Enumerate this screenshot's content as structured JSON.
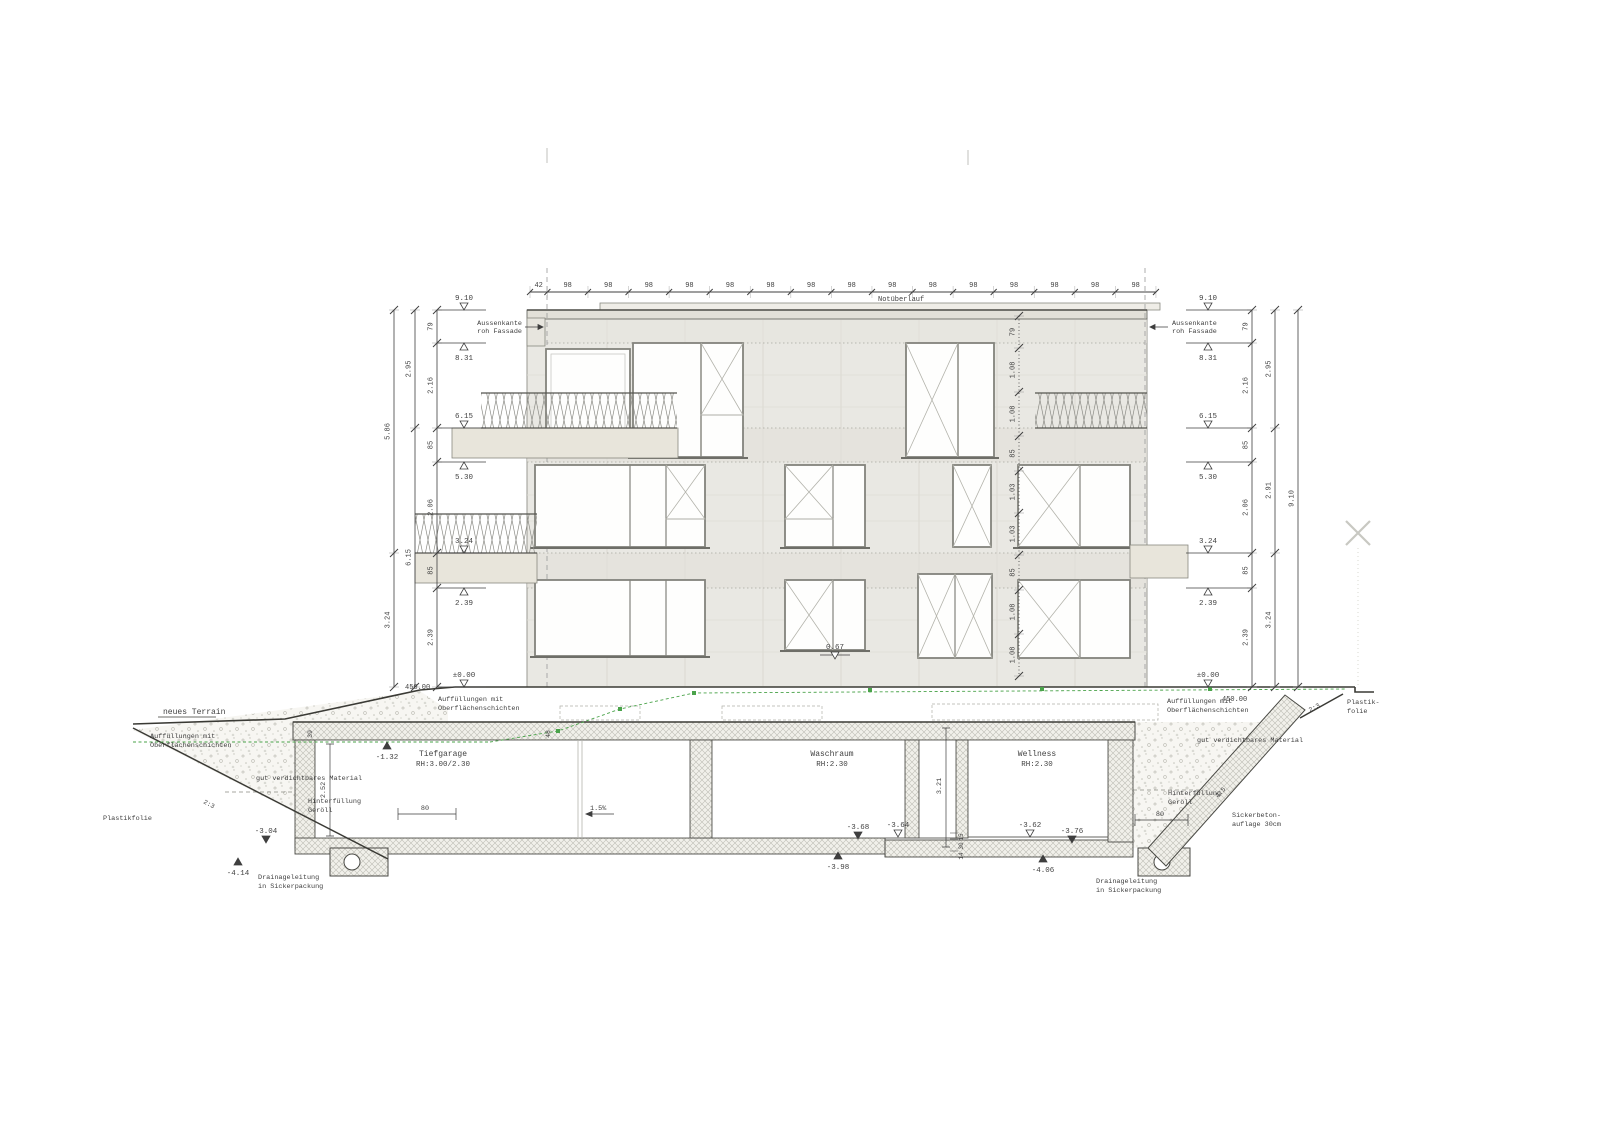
{
  "title": "Gebäudeschnitt / Fassade mit Untergeschoss",
  "colors": {
    "ink": "#3f3f3f",
    "green": "#4aa34a",
    "concrete": "#e9e8e3",
    "beige": "#e8e5db",
    "hatch_line": "#bdbdb5"
  },
  "top_chain": [
    "42",
    "98",
    "98",
    "98",
    "98",
    "98",
    "98",
    "98",
    "98",
    "98",
    "98",
    "98",
    "98",
    "98",
    "98",
    "98"
  ],
  "chains": {
    "left_inner": [
      "79",
      "2.16",
      "85",
      "2.06",
      "85",
      "2.39"
    ],
    "left_mid": [
      "2.95",
      "6.15"
    ],
    "left_outer": [
      "5.86",
      "3.24"
    ],
    "right_inner": [
      "79",
      "2.16",
      "85",
      "2.06",
      "85",
      "2.39"
    ],
    "right_mid": [
      "2.95",
      "2.91",
      "3.24"
    ],
    "right_outer": [
      "9.10"
    ],
    "facade_center": [
      "79",
      "1.08",
      "1.08",
      "85",
      "1.03",
      "1.03",
      "85",
      "1.08",
      "1.08"
    ]
  },
  "level_markers": {
    "left": [
      "9.10",
      "8.31",
      "6.15",
      "5.30",
      "3.24",
      "2.39",
      "±0.00"
    ],
    "right": [
      "9.10",
      "8.31",
      "6.15",
      "5.30",
      "3.24",
      "2.39",
      "±0.00"
    ],
    "facade": "0.67",
    "basement": [
      {
        "v": "-1.32"
      },
      {
        "v": "-3.04"
      },
      {
        "v": "-4.14"
      },
      {
        "v": "-3.68"
      },
      {
        "v": "-3.64"
      },
      {
        "v": "-3.98"
      },
      {
        "v": "-3.62"
      },
      {
        "v": "-3.76"
      },
      {
        "v": "-4.06"
      }
    ]
  },
  "ground": {
    "terrain_label": "neues Terrain",
    "level_left": "450.00",
    "level_right": "450.00"
  },
  "rooms": [
    {
      "name": "Tiefgarage",
      "height": "RH:3.00/2.30"
    },
    {
      "name": "Waschraum",
      "height": "RH:2.30"
    },
    {
      "name": "Wellness",
      "height": "RH:2.30"
    }
  ],
  "annotations": {
    "notueberlauf": "Notüberlauf",
    "aussenkante_line1": "Aussenkante",
    "aussenkante_line2": "roh Fassade",
    "auffuellung_line1": "Auffüllungen mit",
    "auffuellung_line2": "Oberflächenschichten",
    "gut_verdichtbar": "gut verdichtbares Material",
    "hinterfuellung_line1": "Hinterfüllung",
    "hinterfuellung_line2": "Geröll",
    "plastikfolie": "Plastikfolie",
    "plastikfolie_right_line1": "Plastik-",
    "plastikfolie_right_line2": "folie",
    "sickerbeton_line1": "Sickerbeton-",
    "sickerbeton_line2": "auflage 30cm",
    "drainage_line1": "Drainageleitung",
    "drainage_line2": "in Sickerpackung",
    "slope_left": "2:3",
    "slope_right": "2:3",
    "slope_wall": "4:5",
    "garage_slope": "1.5%"
  },
  "small_dims": {
    "wall_top": "39",
    "slab_left": "48",
    "room_left_height": "2.52",
    "basement_height": "3.21",
    "layer_top": "15",
    "layer_mid": "30",
    "layer_bot": "14",
    "hinterfuellung_left": "80",
    "hinterfuellung_right": "80"
  }
}
